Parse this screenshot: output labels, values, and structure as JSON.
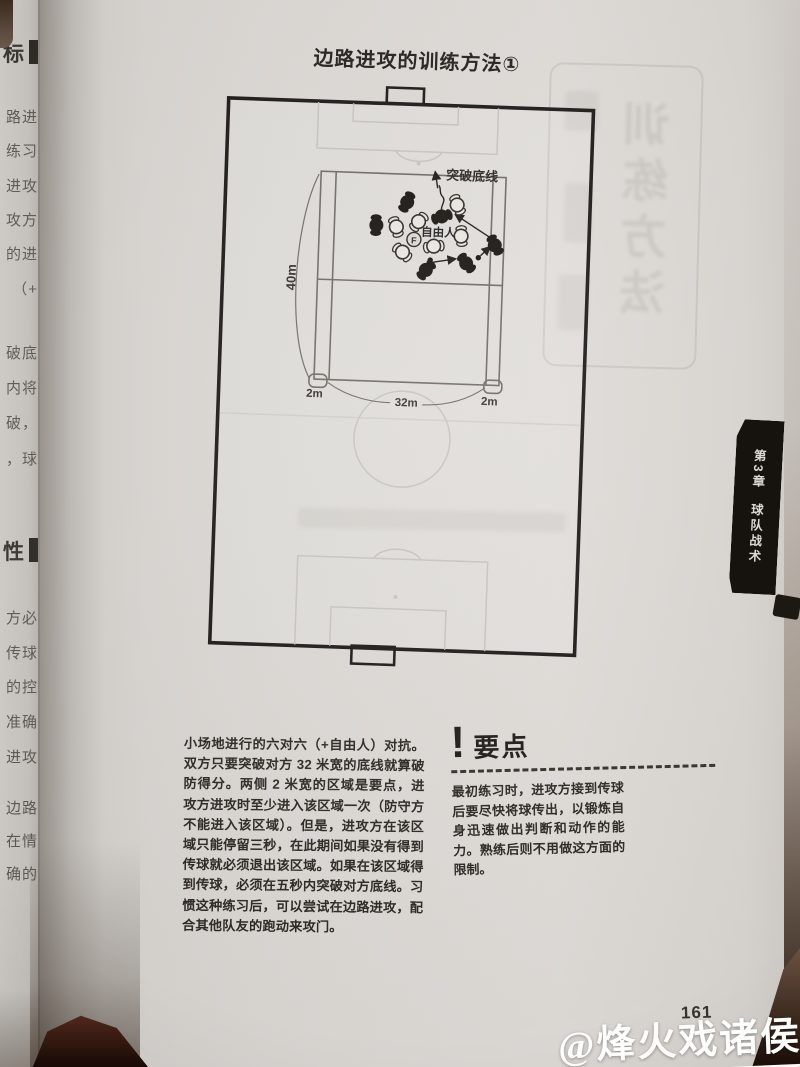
{
  "page": {
    "title": "边路进攻的训练方法①",
    "page_number": "161",
    "watermark": "@烽火戏诸侯",
    "tab": {
      "chapter": "第3章",
      "section": "球队战术"
    },
    "body_paragraph": "小场地进行的六对六（+自由人）对抗。双方只要突破对方 32 米宽的底线就算破防得分。两侧 2 米宽的区域是要点，进攻方进攻时至少进入该区域一次（防守方不能进入该区域）。但是，进攻方在该区域只能停留三秒，在此期间如果没有得到传球就必须退出该区域。如果在该区域得到传球，必须在五秒内突破对方底线。习惯这种练习后，可以尝试在边路进攻，配合其他队友的跑动来攻门。",
    "key_points": {
      "icon": "!",
      "heading": "要点",
      "text": "最初练习时，进攻方接到传球后要尽快将球传出，以锻炼自身迅速做出判断和动作的能力。熟练后则不用做这方面的限制。"
    }
  },
  "diagram": {
    "labels": {
      "breakthrough": "突破底线",
      "free_player": "自由人",
      "free_player_mark": "F",
      "grid_length": "40m",
      "channel_left": "2m",
      "channel_center": "32m",
      "channel_right": "2m"
    },
    "teams": {
      "attackers": "white",
      "defenders": "black",
      "attackers_count": 6,
      "defenders_count": 6,
      "extra": "自由人(F)"
    }
  },
  "left_page_edge": {
    "fragments": [
      "标",
      "路进",
      "练习",
      "进攻",
      "攻方",
      "的进",
      "（+",
      "破底",
      "内将",
      "破，",
      "，球",
      "性",
      "方必",
      "传球",
      "的控",
      "准确",
      "进攻",
      "边路",
      "在情",
      "确的"
    ]
  },
  "bleed_through": {
    "ghost_text": "训练方法"
  },
  "colors": {
    "page": "#dad7d3",
    "ink": "#2c2823",
    "frame": "#1b1816",
    "tab_bg": "#16120e",
    "watermark": "#fdfdfc",
    "cover_dark": "#2a150c"
  }
}
